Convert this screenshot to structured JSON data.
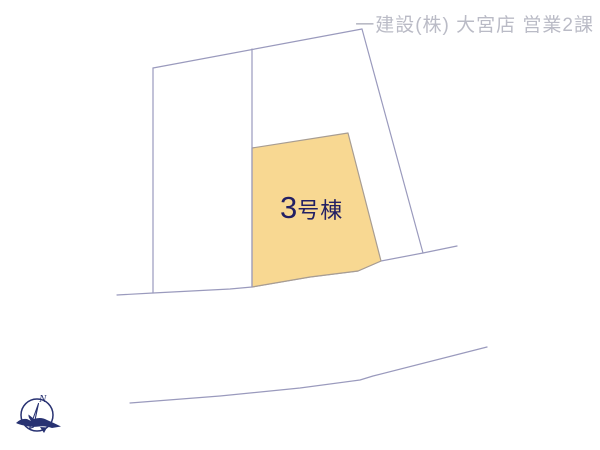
{
  "header": {
    "company": "一建設(株) 大宮店 営業2課"
  },
  "plot": {
    "number": "3",
    "suffix": "号棟",
    "full_label": "3号棟"
  },
  "compass": {
    "north_label": "N"
  },
  "colors": {
    "background": "#ffffff",
    "parcel_line": "#9a9abd",
    "plot_fill": "#f8d892",
    "plot_label_text": "#232064",
    "header_text": "#babbc6",
    "compass_navy": "#283272"
  }
}
